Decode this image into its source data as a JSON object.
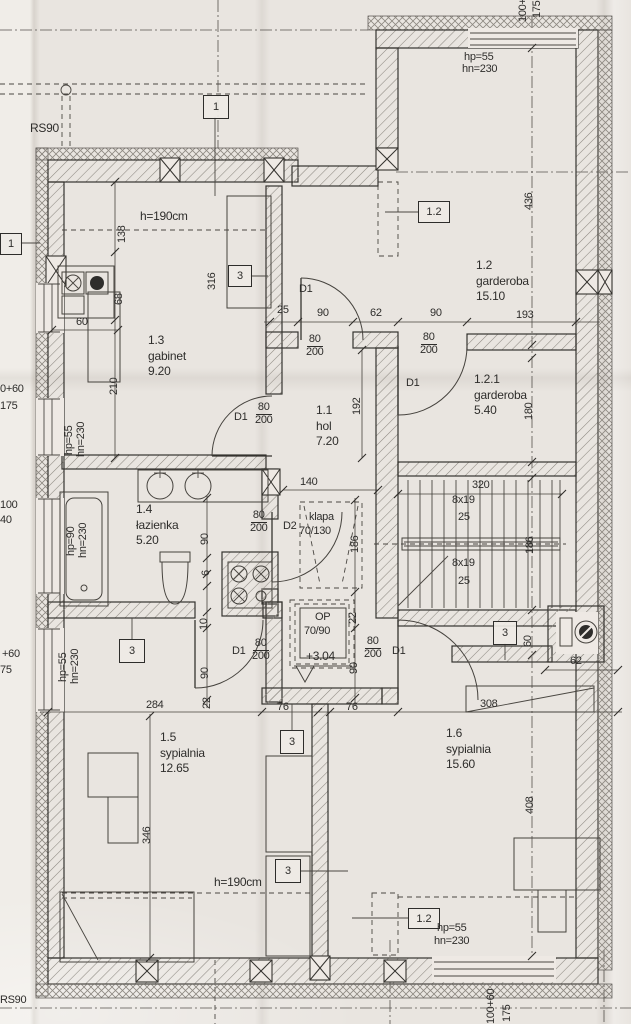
{
  "plan": {
    "rooms": [
      {
        "id": "1.1",
        "name": "hol",
        "area": "7.20"
      },
      {
        "id": "1.2",
        "name": "garderoba",
        "area": "15.10"
      },
      {
        "id": "1.2.1",
        "name": "garderoba",
        "area": "5.40"
      },
      {
        "id": "1.3",
        "name": "gabinet",
        "area": "9.20"
      },
      {
        "id": "1.4",
        "name": "łazienka",
        "area": "5.20"
      },
      {
        "id": "1.5",
        "name": "sypialnia",
        "area": "12.65"
      },
      {
        "id": "1.6",
        "name": "sypialnia",
        "area": "15.60"
      }
    ],
    "openings": {
      "d1": "D1",
      "d2": "D2",
      "w80": "80",
      "h200": "200",
      "hp55": "hp=55",
      "hn230": "hn=230",
      "hp90": "hp=90",
      "klapa": "klapa",
      "klapa_size": "70/130",
      "op": "OP",
      "op_size": "70/90"
    },
    "stairs": {
      "steps": "8x19",
      "width": "25",
      "run": "320",
      "well": "186"
    },
    "annotations": {
      "h190": "h=190cm",
      "level": "+3.04",
      "rs90": "RS90"
    },
    "refs": {
      "r1": "1",
      "r3": "3",
      "r12": "1.2"
    },
    "dims": {
      "6": "6",
      "10": "10",
      "22": "22",
      "25": "25",
      "60": "60",
      "62": "62",
      "68": "68",
      "76": "76",
      "90": "90",
      "138": "138",
      "140": "140",
      "180": "180",
      "186": "186",
      "192": "192",
      "193": "193",
      "210": "210",
      "284": "284",
      "308": "308",
      "316": "316",
      "320": "320",
      "346": "346",
      "408": "408",
      "436": "436"
    },
    "edge": {
      "e0_60": "0+60",
      "e175": "175",
      "e100": "100",
      "e40": "40",
      "ep60": "+60",
      "e75": "75",
      "e100p": "100+",
      "e100_60": "100+60"
    }
  }
}
